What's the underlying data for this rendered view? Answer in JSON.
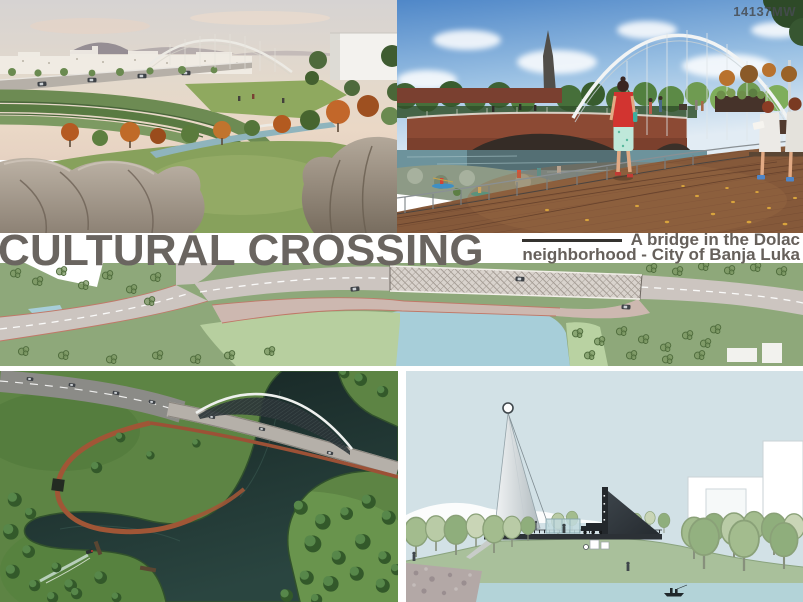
{
  "board": {
    "code": "14137MW",
    "title": "CULTURAL CROSSING",
    "subtitle_line1": "A bridge in the Dolac",
    "subtitle_line2": "neighborhood - City of Banja Luka"
  },
  "colors": {
    "title_text": "#6a6560",
    "subtitle_text": "#66605b",
    "code_text": "#474c52",
    "title_band": "#ffffff",
    "plan_green": "#8ea87a",
    "plan_river": "#a7ced9",
    "aerial_field": "#5d8444",
    "aerial_water": "#1b2c2a",
    "elevation_sky": "#d2e1e6",
    "boardwalk_wood": "#85593a",
    "brick_bridge": "#8c4a34"
  }
}
